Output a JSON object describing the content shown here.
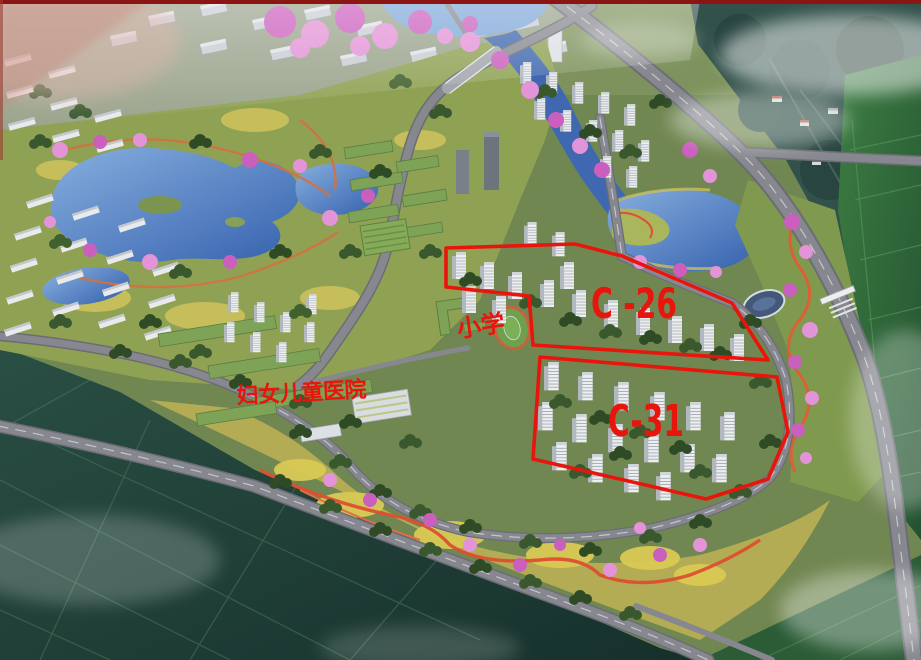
{
  "annotations": {
    "accent_color": "#e8150d",
    "parcels": [
      {
        "id": "C-26",
        "label": "C -26",
        "points": "446,248 575,244 622,256 732,303 768,360 533,345 529,296 446,287"
      },
      {
        "id": "C-31",
        "label": "C-31",
        "points": "540,357 777,377 788,432 768,479 706,499 533,459"
      }
    ],
    "places": [
      {
        "id": "primary-school",
        "label": "小学"
      },
      {
        "id": "women-children-hospital",
        "label": "妇女儿童医院"
      }
    ]
  },
  "scene": {
    "water_color": "#4f7cc0",
    "road_color": "#87888f",
    "farmland_color": "#23413a",
    "vegetation_color": "#3a582d",
    "blossom_color": "#cc66c0",
    "tower_color": "#eceef0"
  }
}
